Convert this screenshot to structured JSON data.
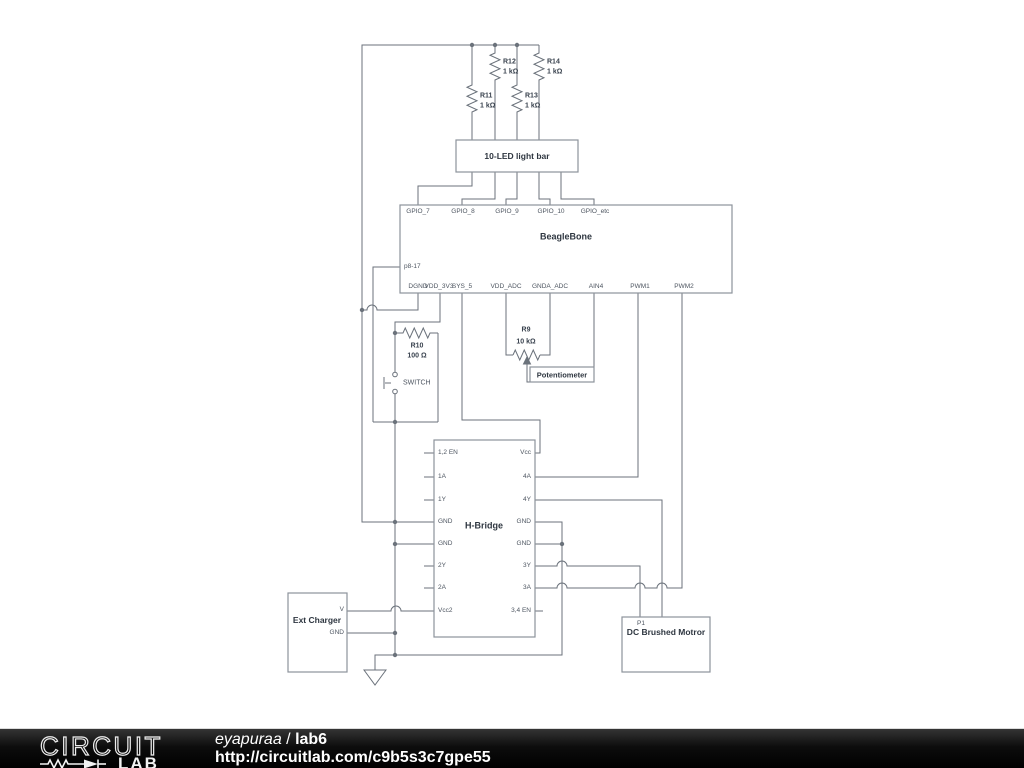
{
  "schematic": {
    "resistors": {
      "r11": {
        "ref": "R11",
        "value": "1 kΩ"
      },
      "r12": {
        "ref": "R12",
        "value": "1 kΩ"
      },
      "r13": {
        "ref": "R13",
        "value": "1 kΩ"
      },
      "r14": {
        "ref": "R14",
        "value": "1 kΩ"
      },
      "r10": {
        "ref": "R10",
        "value": "100 Ω"
      },
      "r9": {
        "ref": "R9",
        "value": "10 kΩ"
      }
    },
    "led_bar": {
      "label": "10-LED light bar"
    },
    "beaglebone": {
      "label": "BeagleBone",
      "left_pin": "p8-17",
      "top_pins": [
        "GPIO_7",
        "GPIO_8",
        "GPIO_9",
        "GPIO_10",
        "GPIO_etc"
      ],
      "bottom_pins": [
        "DGND",
        "VDD_3V3",
        "SYS_5",
        "VDD_ADC",
        "GNDA_ADC",
        "AIN4",
        "PWM1",
        "PWM2"
      ]
    },
    "switch": {
      "label": "SWITCH"
    },
    "potentiometer": {
      "label": "Potentiometer"
    },
    "hbridge": {
      "label": "H-Bridge",
      "left_pins": [
        "1,2 EN",
        "1A",
        "1Y",
        "GND",
        "GND",
        "2Y",
        "2A",
        "Vcc2"
      ],
      "right_pins": [
        "Vcc",
        "4A",
        "4Y",
        "GND",
        "GND",
        "3Y",
        "3A",
        "3,4 EN"
      ]
    },
    "ext_charger": {
      "label": "Ext Charger",
      "pins": [
        "V",
        "GND"
      ]
    },
    "motor": {
      "ref": "P1",
      "label": "DC Brushed Motror"
    }
  },
  "footer": {
    "logo_top": "CIRCUIT",
    "logo_bottom": "LAB",
    "author": "eyapuraa",
    "separator": " / ",
    "project": "lab6",
    "url": "http://circuitlab.com/c9b5s3c7gpe55"
  },
  "colors": {
    "wire": "#6b727b",
    "component_outline": "#8d939b",
    "pin_text": "#4d5560",
    "label_text": "#2e3640",
    "footer_bg": "#000000",
    "footer_text": "#ffffff"
  }
}
